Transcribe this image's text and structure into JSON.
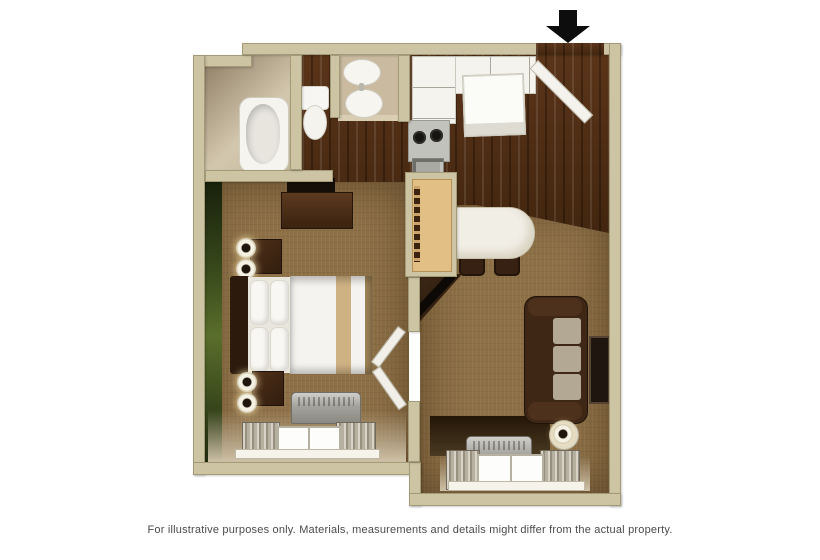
{
  "caption": "For illustrative purposes only.  Materials, measurements and details might differ from the actual property.",
  "entrance": {
    "indicator": "entrance-arrow",
    "direction": "down",
    "position": "top-right-of-plan"
  },
  "plan": {
    "type": "one-room suite floor plan, top-down 3D illustration",
    "rooms": [
      {
        "name": "bathroom",
        "features": [
          "bathtub",
          "toilet",
          "vanity-sink",
          "vanity-mirror"
        ]
      },
      {
        "name": "kitchen",
        "features": [
          "l-shaped-counter",
          "refrigerator",
          "two-burner-stove",
          "kitchen-sink",
          "pass-through-divider",
          "breakfast-bar",
          "two-stools"
        ]
      },
      {
        "name": "bedroom",
        "features": [
          "green-accent-wall",
          "dresser",
          "tv-on-dresser",
          "queen-bed",
          "nightstand-with-lamps-x2",
          "ac-unit",
          "window-with-curtains",
          "bifold-door"
        ]
      },
      {
        "name": "living-area",
        "features": [
          "corner-tv-stand",
          "sofa",
          "wall-picture",
          "floor-lamp",
          "ac-unit",
          "window-with-curtains"
        ]
      },
      {
        "name": "entry",
        "features": [
          "open-entry-door",
          "dark-wood-floor"
        ]
      }
    ]
  },
  "colors": {
    "wall_khaki": "#cdc4a3",
    "wall_edge": "#a59c7a",
    "carpet_brown": "#8d7046",
    "wood_floor": "#4b2c15",
    "accent_wall_green": "#4f6426",
    "bed_linen_white": "#f4f3ef",
    "bed_stripe_tan": "#cfb284",
    "sofa_brown": "#3e2715",
    "counter_white": "#f3f2ed",
    "arrow_black": "#111111",
    "caption_gray": "#4a4a4a"
  }
}
